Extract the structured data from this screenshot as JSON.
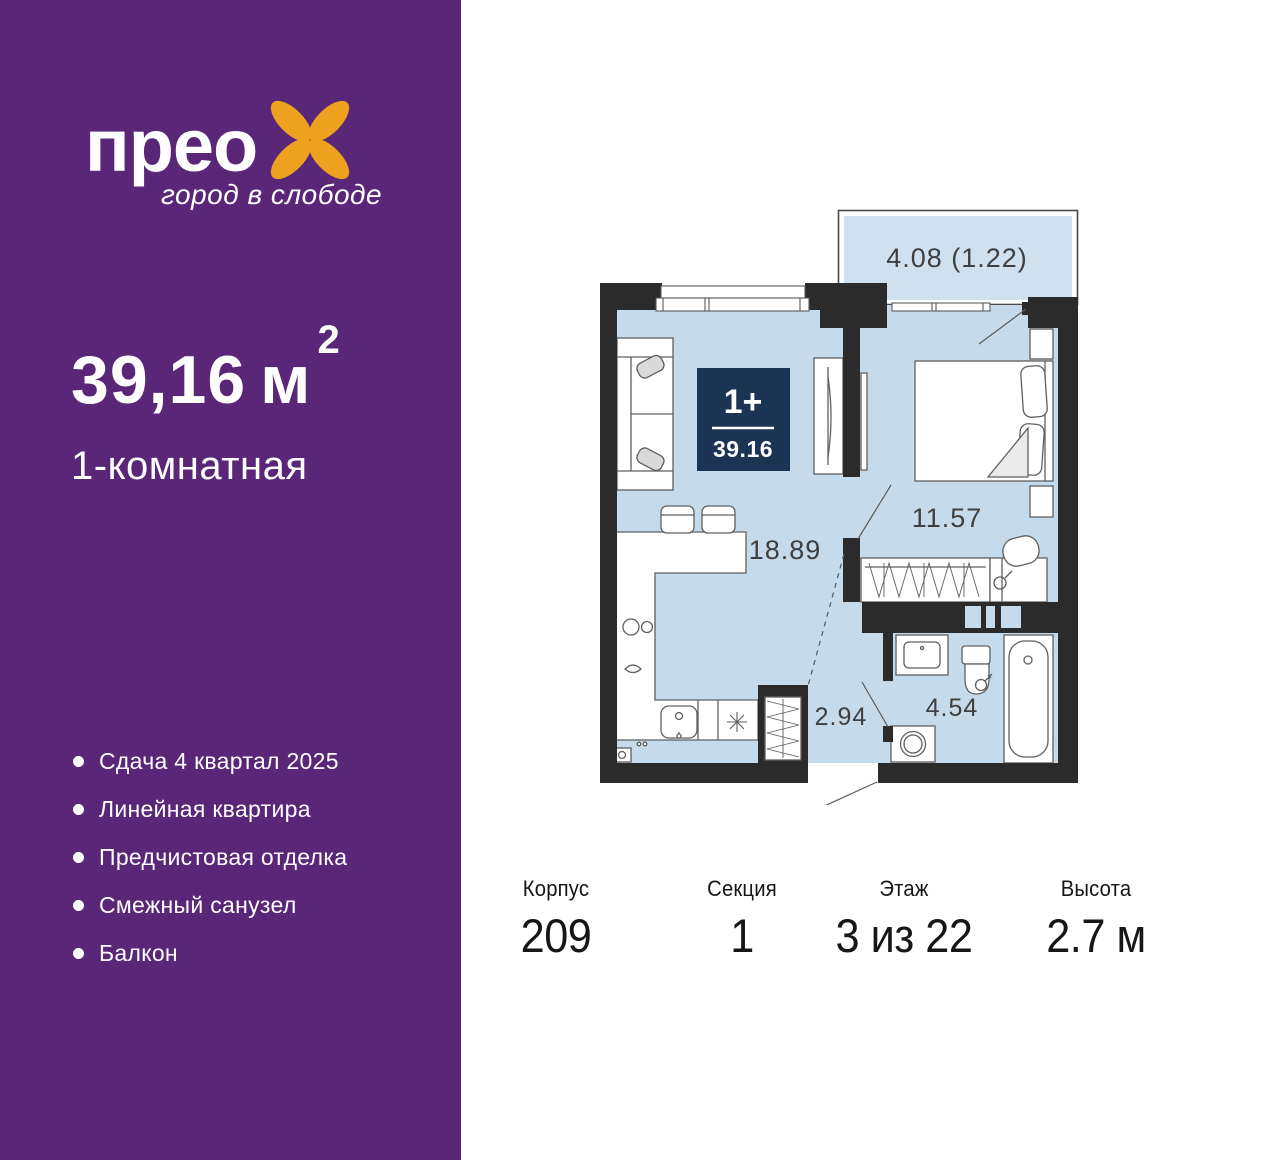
{
  "colors": {
    "purple": "#592678",
    "orange": "#eea11e",
    "navy": "#1c3453",
    "floor_blue": "#c5dbeb",
    "wall": "#2b2b2b"
  },
  "sidebar": {
    "brand": "прео",
    "tagline": "город в слободе",
    "area": {
      "value": "39,16",
      "unit": "м",
      "sup": "2"
    },
    "type_label": "1-комнатная",
    "features": [
      "Сдача 4 квартал 2025",
      "Линейная квартира",
      "Предчистовая отделка",
      "Смежный санузел",
      "Балкон"
    ]
  },
  "plan": {
    "badge": {
      "rooms": "1+",
      "area": "39.16"
    },
    "labels": {
      "balcony": "4.08 (1.22)",
      "living": "18.89",
      "bedroom": "11.57",
      "hallway": "2.94",
      "bathroom": "4.54"
    }
  },
  "footer": {
    "columns": [
      {
        "label": "Корпус",
        "value": "209"
      },
      {
        "label": "Секция",
        "value": "1"
      },
      {
        "label": "Этаж",
        "value": "3 из 22"
      },
      {
        "label": "Высота",
        "value": "2.7 м"
      }
    ]
  }
}
